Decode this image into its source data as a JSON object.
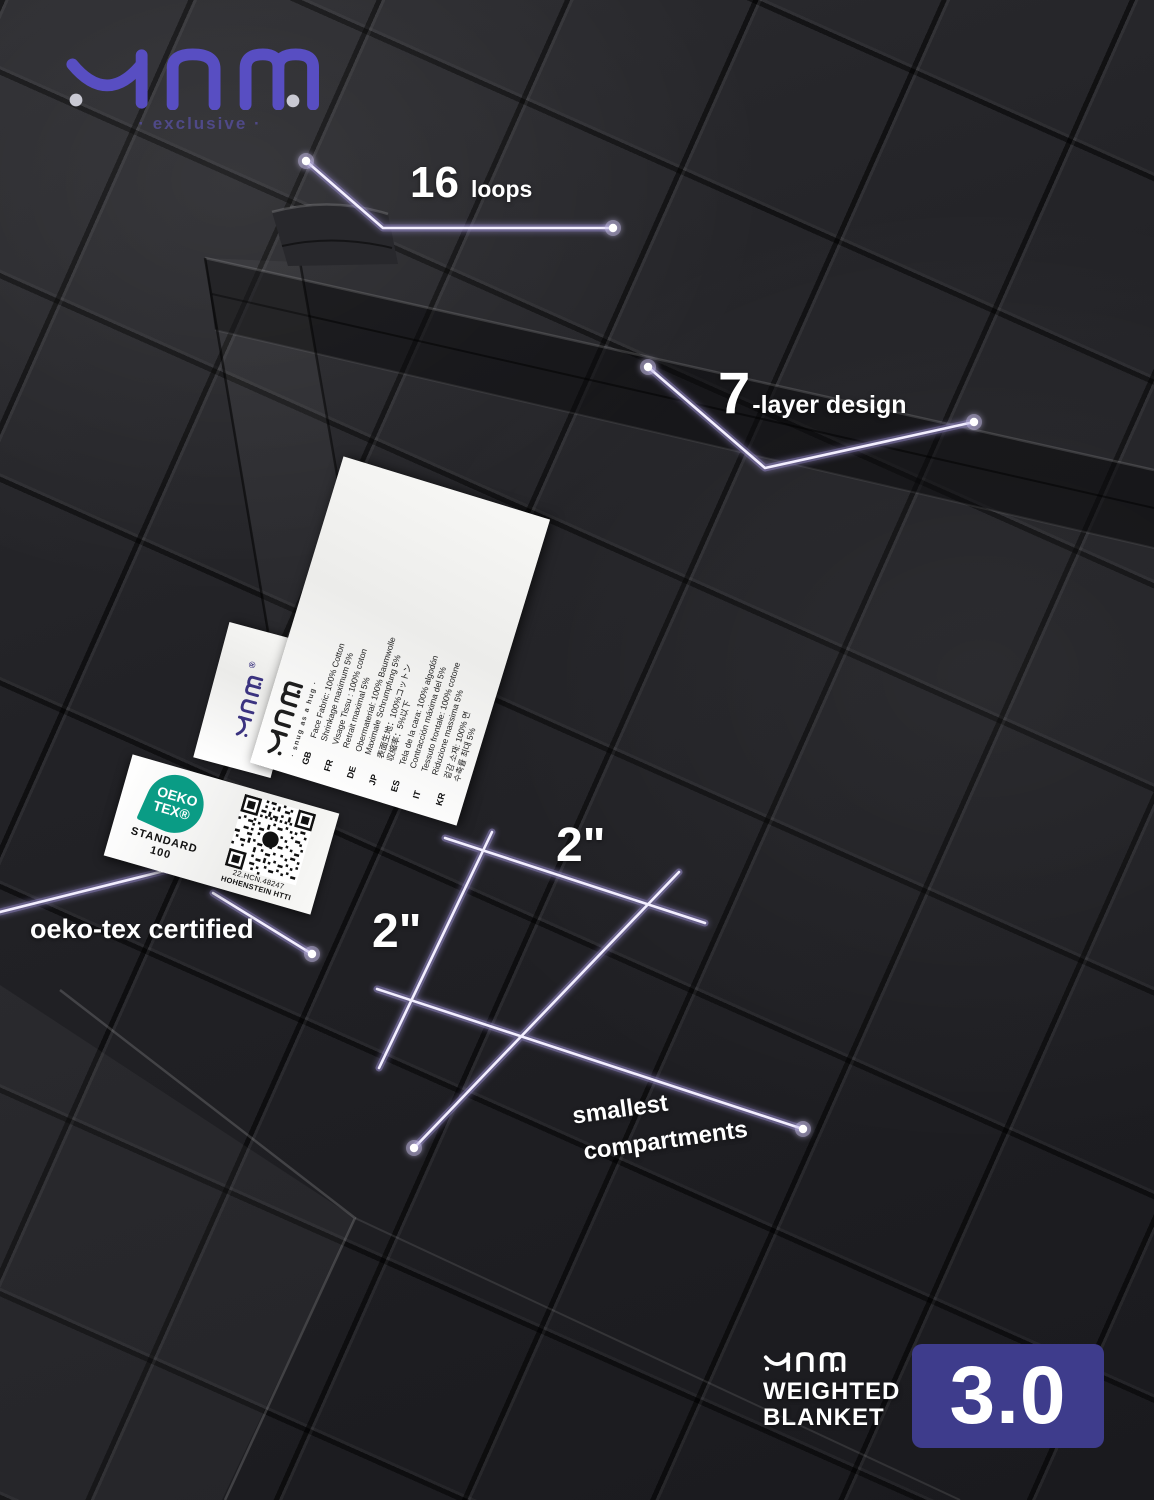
{
  "header": {
    "logo": "YNM",
    "tagline": "· exclusive ·"
  },
  "callouts": {
    "loops": {
      "value": "16",
      "label": "loops"
    },
    "layers": {
      "value": "7",
      "label": "-layer design"
    },
    "cell_width": "2\"",
    "cell_height": "2\"",
    "compartments": {
      "line1": "smallest",
      "line2": "compartments"
    },
    "certification": "oeko-tex certified"
  },
  "care_label": {
    "brand": "YNM",
    "slogan": "· snug as a hug ·",
    "rows": [
      {
        "code": "GB",
        "line1": "Face Fabric: 100% Cotton",
        "line2": "Shrinkage maximum 5%"
      },
      {
        "code": "FR",
        "line1": "Visage Tissu : 100% coton",
        "line2": "Retrait maximal 5%"
      },
      {
        "code": "DE",
        "line1": "Obermaterial: 100% Baumwolle",
        "line2": "Maximale Schrumpfung 5%"
      },
      {
        "code": "JP",
        "line1": "表面生地：100%コットン",
        "line2": "収縮率：5%以下"
      },
      {
        "code": "ES",
        "line1": "Tela de la cara: 100% algodón",
        "line2": "Contracción máxima del 5%"
      },
      {
        "code": "IT",
        "line1": "Tessuto frontale: 100% cotone",
        "line2": "Riduzione massima 5%"
      },
      {
        "code": "KR",
        "line1": "겉감 소재: 100% 면",
        "line2": "수축률 최대 5%"
      }
    ]
  },
  "brand_label": {
    "brand": "YNM",
    "registered": "®"
  },
  "oeko_label": {
    "logo_top": "OEKO",
    "logo_bottom": "TEX®",
    "standard_line1": "STANDARD",
    "standard_line2": "100",
    "cert_number": "22.HCN.48247",
    "institute": "HOHENSTEIN HTTI"
  },
  "badge": {
    "brand": "YNM",
    "title_line1": "WEIGHTED",
    "title_line2": "BLANKET",
    "version": "3.0"
  },
  "colors": {
    "accent_purple": "#584ec2",
    "badge_purple": "#3e3c8c",
    "leader_lavender": "#cdc5ec",
    "oeko_green": "#0a9c85",
    "fabric_black": "#212125",
    "text_white": "#ffffff"
  }
}
